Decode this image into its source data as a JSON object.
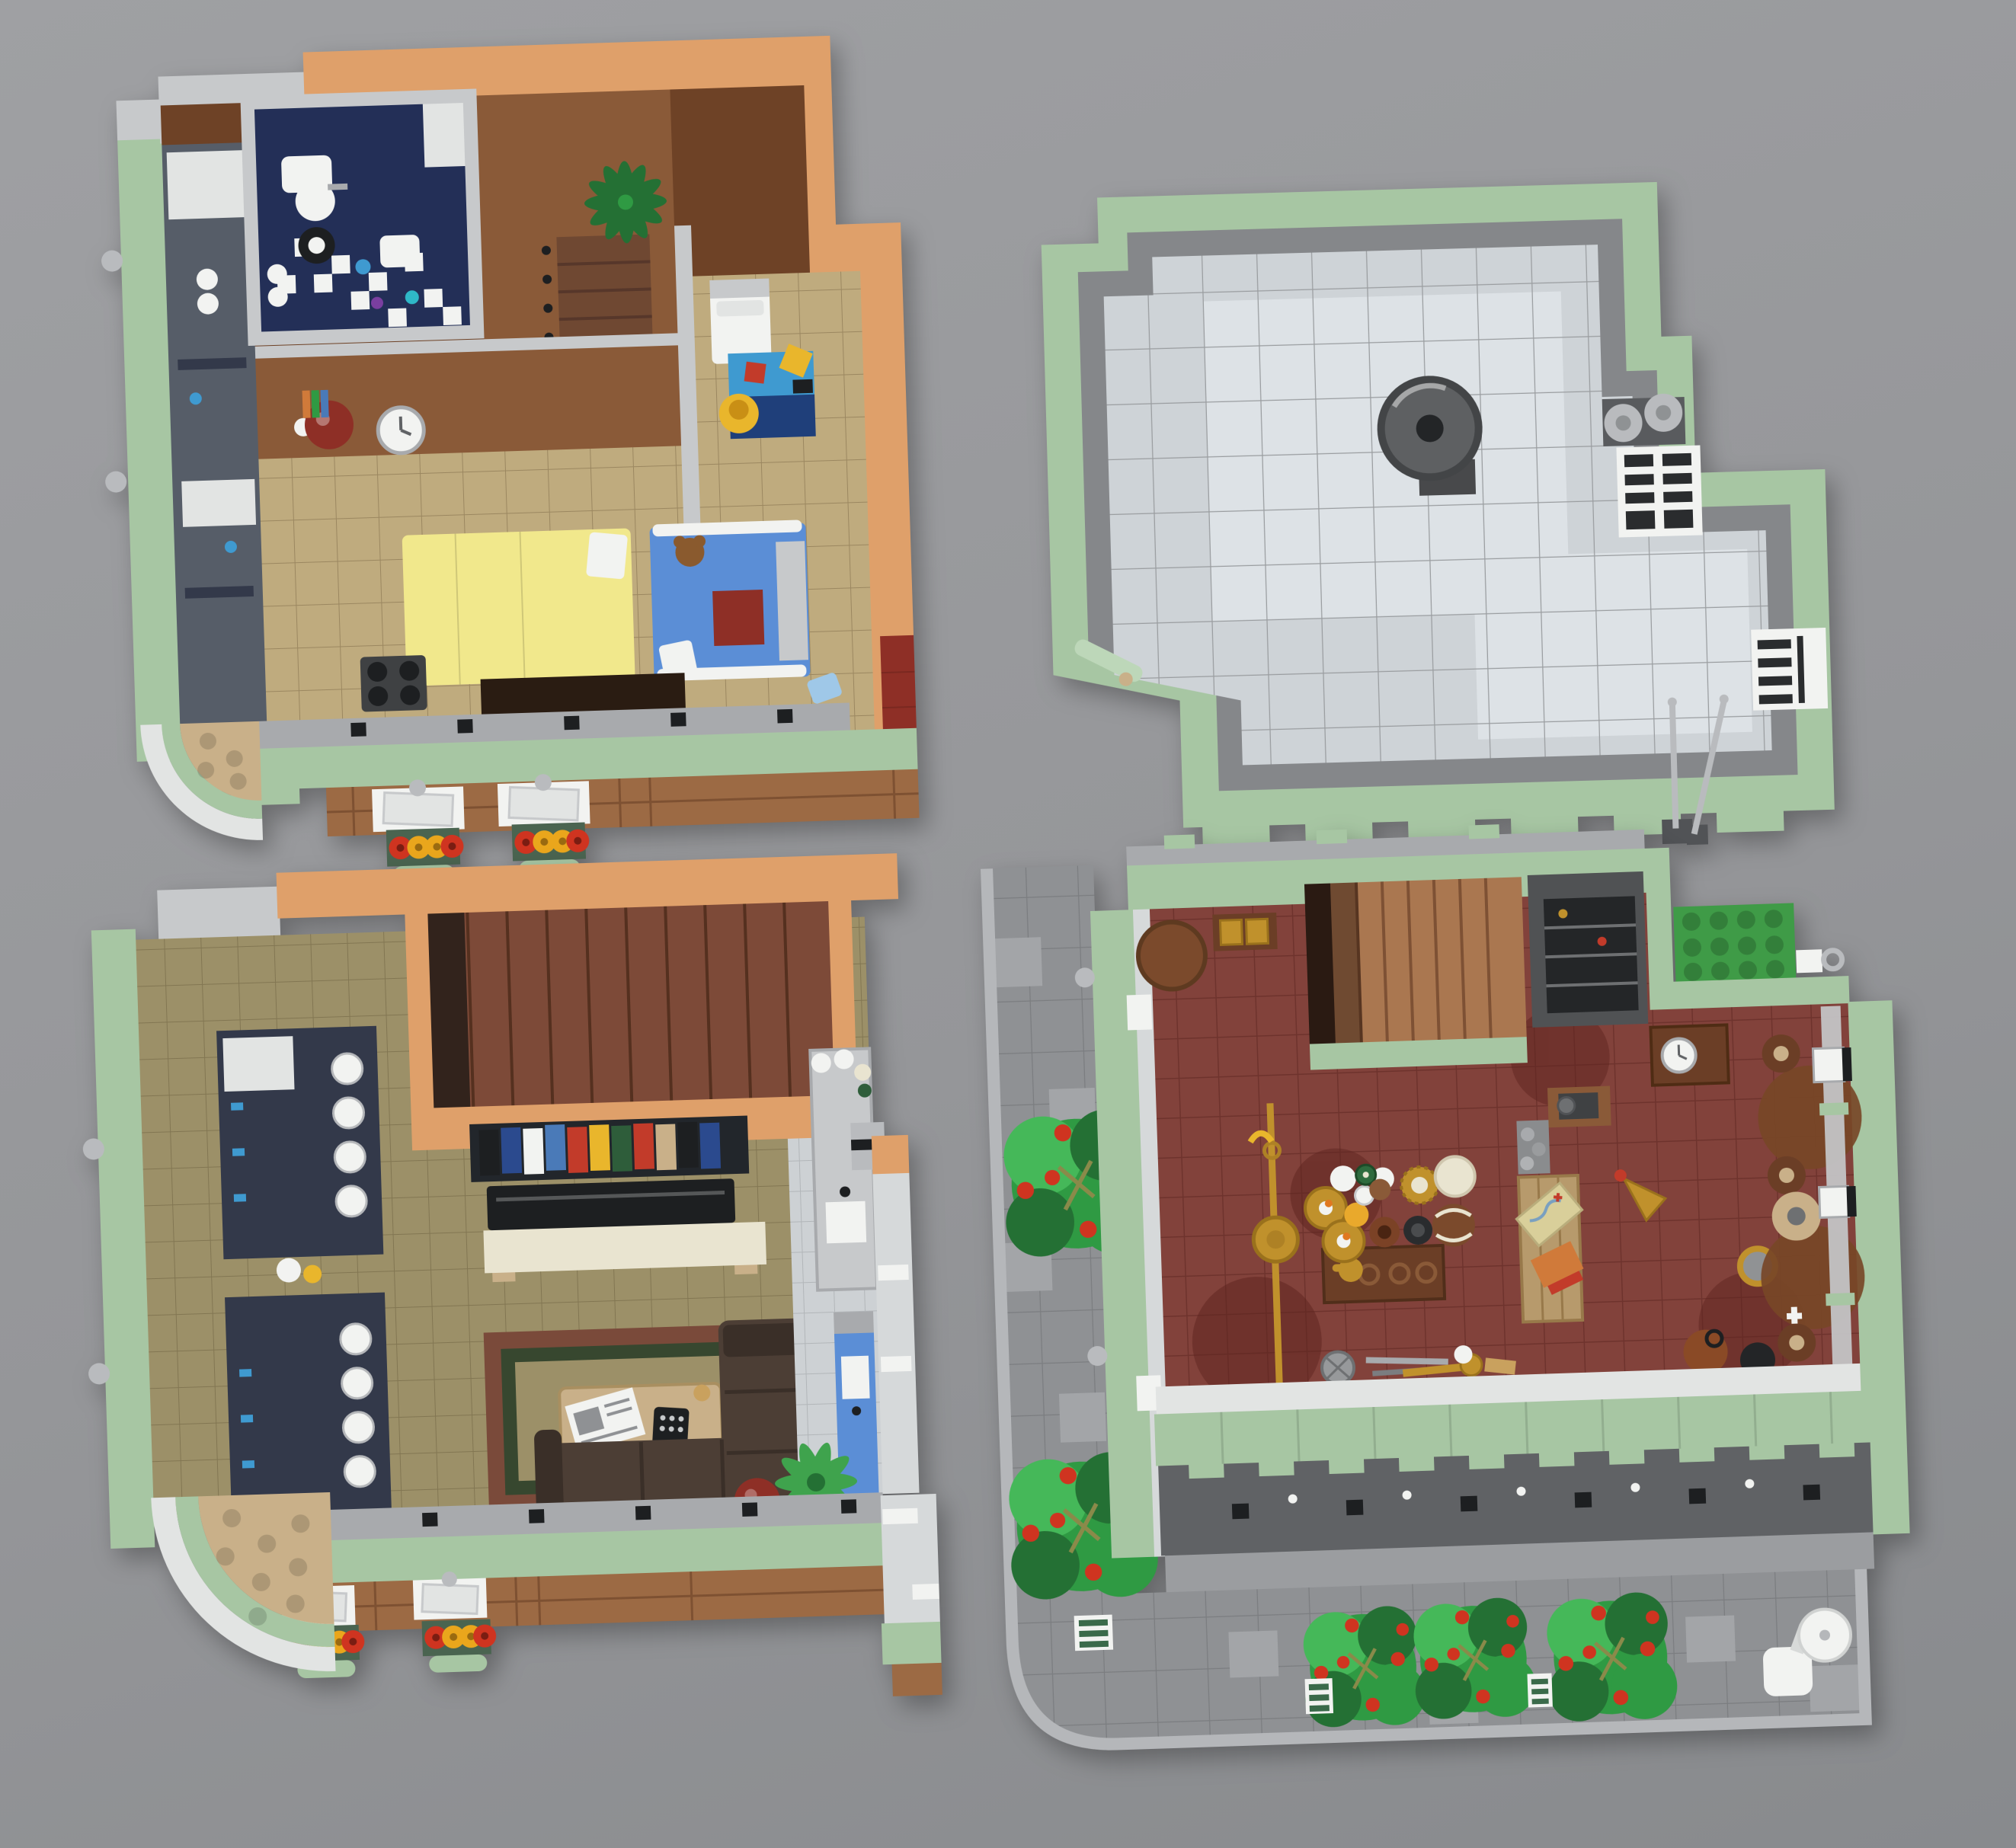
{
  "palette": {
    "bg_top": "#9fa0a3",
    "bg_mid": "#959699",
    "bg_bottom": "#888a8d",
    "sand_green": "#a7c6a3",
    "sand_green_light": "#bdd7b9",
    "sand_green_dark": "#86a882",
    "nougat": "#dfa06a",
    "nougat_dark": "#c5854f",
    "brick": "#9c6a44",
    "brick_line": "#7e5132",
    "wall_brown": "#8a5a38",
    "wall_brown_dark": "#6e4226",
    "stair_brown_a": "#6f4832",
    "stair_brown_c": "#7d4a38",
    "stair_brown_d": "#aa7750",
    "floor_tan": "#bfab7e",
    "floor_olive": "#9c9068",
    "floor_olive_line": "#857a54",
    "floor_red": "#82423b",
    "floor_red_line": "#6e332d",
    "floor_red_stain": "#5e241f",
    "kitchen_tile": "#cdd1d4",
    "kitchen_line": "#b2b6b9",
    "roof_tile": "#ced3d7",
    "roof_tile_light": "#dde2e6",
    "roof_gray": "#85878a",
    "roof_line": "#9a9da0",
    "navy": "#232f57",
    "shelf_navy": "#33394a",
    "slate": "#565d68",
    "blue_item": "#5b8ed6",
    "mat_blue": "#3f9ad0",
    "mat_navy": "#1f3f7a",
    "lt_blue": "#9fc8e8",
    "yellow_bed": "#f1e88c",
    "yellow_item": "#e9b62c",
    "red_item": "#c23b2a",
    "dark_red": "#8e2f26",
    "rug_red": "#7a4a3a",
    "rug_green": "#37472f",
    "foliage": "#2f9a43",
    "foliage_dark": "#247034",
    "foliage_light": "#45b859",
    "olive_stem": "#8a8a4a",
    "flower_red": "#cf3420",
    "flower_yellow": "#eaa61c",
    "box_green": "#4a6450",
    "gold": "#c0912c",
    "gold_dark": "#9a711c",
    "brass": "#ae8125",
    "sofa": "#4c3e35",
    "sofa_dark": "#3a2f28",
    "cream": "#e9e4d0",
    "tan": "#c9b089",
    "map_tan": "#d9cf9a",
    "orange_book": "#d07a3a",
    "white": "#f2f3f1",
    "off_white": "#e2e4e3",
    "glass": "#d6d9da",
    "gray_light": "#c7c9cb",
    "gray_med": "#a8aaad",
    "gray_dark": "#606265",
    "near_black": "#1d1f21",
    "silver": "#b9bbbe",
    "steel": "#6e7072",
    "machine_gray": "#3f4143",
    "sidewalk": "#8f9194",
    "sidewalk_light": "#a3a5a8",
    "sidewalk_line": "#7b7d80",
    "curb": "#b5b7ba",
    "green_plate": "#3f9b47",
    "bottle_green": "#2e6b3e",
    "clay": "#7b4226",
    "wood_mid": "#7b4a2c",
    "wood_dark": "#6b3e26",
    "onion": "#8a4a26",
    "book_blue": "#2b4a8e",
    "book_blue2": "#4a7ab8",
    "book_green": "#2e5d3a",
    "teal": "#2fb8c8",
    "purple": "#7a3fa0",
    "cab_gray": "#505254"
  },
  "scene": {
    "type": "top-down photo of four LEGO modular building sections on gray surface",
    "modules": [
      {
        "id": "upper-floor-module",
        "position": "top-left",
        "items": [
          "bathroom with checkered floor",
          "tub",
          "sink",
          "round-mirror",
          "toilet",
          "staircase",
          "palm-plant",
          "white-bed",
          "blue-play-mat",
          "yellow-chair",
          "yellow-bed",
          "blue-bed-with-teddy",
          "red-bunk",
          "wall-clock",
          "red-sphere-lamp",
          "stove",
          "facade-windows",
          "flower-boxes",
          "curved-corner"
        ]
      },
      {
        "id": "roof-module",
        "position": "top-right",
        "items": [
          "sand-green parapet",
          "gray tiled roof",
          "vent-dish",
          "twin-canister-vents",
          "pallet-grate",
          "roof-hatch-grate",
          "antenna-poles",
          "stair-notch"
        ]
      },
      {
        "id": "living-floor-module",
        "position": "bottom-left",
        "items": [
          "staircase",
          "shop-shelves with cups",
          "bookshelf with colored books",
          "tv",
          "sideboard",
          "area-rug",
          "coffee-table with newspaper and remote",
          "l-shaped-sofa",
          "red-sphere-lamp",
          "kitchen-counter",
          "coffee-machine",
          "blue-island with sink",
          "ceiling-fan",
          "facade-windows",
          "flower-boxes",
          "curved-corner"
        ]
      },
      {
        "id": "ground-floor-module",
        "position": "bottom-right",
        "items": [
          "sidewalk",
          "street-trees with red blossoms",
          "storm-grates",
          "patio-table",
          "staircase",
          "green-roof-plate",
          "round-shop-table",
          "brass-pole-horn",
          "candlestick-display-table",
          "tea-set",
          "vases",
          "gold-jar",
          "map-desk with treasure map and orange book",
          "stone-shelf",
          "sewing-machine-table",
          "wall-clock-case",
          "gold-cone-lamp",
          "bar-stools",
          "glass-display-rail",
          "south-facade",
          "bushes"
        ]
      }
    ]
  }
}
